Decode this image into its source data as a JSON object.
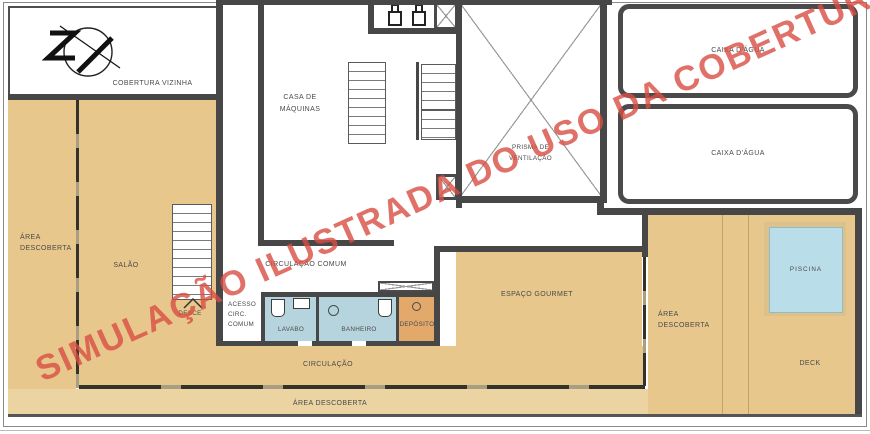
{
  "plan": {
    "watermark": "SIMULAÇÃO ILUSTRADA DO USO DA COBERTURA",
    "labels": {
      "cobertura_vizinha": "COBERTURA VIZINHA",
      "casa_de_maquinas": "CASA DE\nMÁQUINAS",
      "prisma_ventilacao": "PRISMA DE\nVENTILAÇÃO",
      "caixa_dagua_1": "CAIXA D'ÁGUA",
      "caixa_dagua_2": "CAIXA D'ÁGUA",
      "area_descoberta_left": "ÁREA\nDESCOBERTA",
      "salao": "SALÃO",
      "desce": "DESCE",
      "acesso_circ_comum": "ACESSO\nCIRC.\nCOMUM",
      "circulacao_comum": "CIRCULAÇÃO COMUM",
      "lavabo": "LAVABO",
      "banheiro": "BANHEIRO",
      "deposito": "DEPÓSITO",
      "espaco_gourmet": "ESPAÇO GOURMET",
      "area_descoberta_right": "ÁREA\nDESCOBERTA",
      "piscina": "PISCINA",
      "deck": "DECK",
      "circulacao": "CIRCULAÇÃO",
      "area_descoberta_bottom": "ÁREA DESCOBERTA"
    },
    "colors": {
      "open_area": "#e7c78c",
      "open_area_light": "#ecd4a2",
      "wall": "#474747",
      "wet_floor": "#b6d4de",
      "pool_water": "#b9dde9",
      "deposito_floor": "#e2a96b",
      "watermark_red": "#d84d42",
      "label_text": "#4a4a4a"
    },
    "icons": [
      "north-arrow-icon",
      "pump-icon",
      "shaft-x-icon",
      "ventilation-x-icon",
      "prisma-x-icon",
      "toilet-icon",
      "sink-icon",
      "shower-icon",
      "drain-icon",
      "stairs-up-arrow-icon"
    ]
  }
}
